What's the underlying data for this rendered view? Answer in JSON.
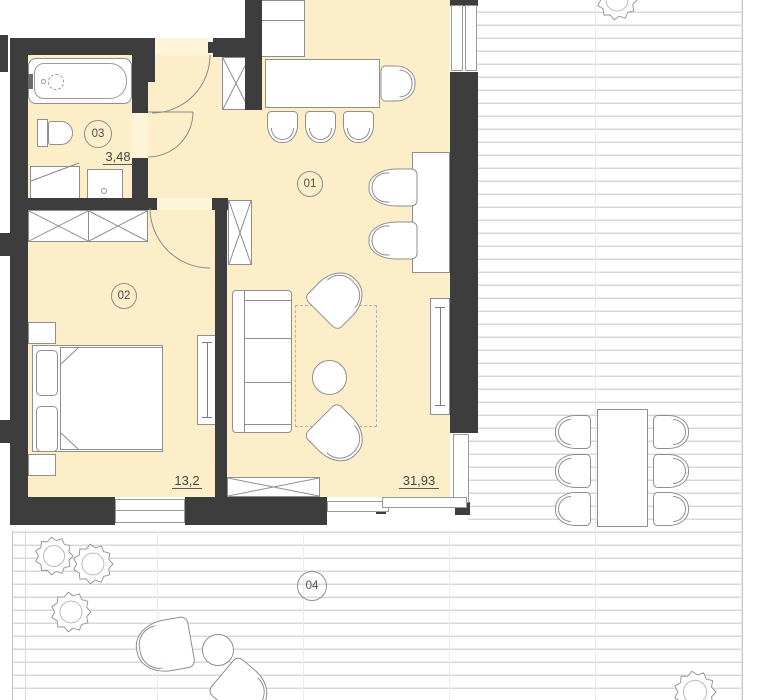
{
  "plan_title": "apartment-floor-plan-with-terrace",
  "rooms": {
    "living": {
      "number": "01",
      "area": "31,93"
    },
    "bedroom": {
      "number": "02",
      "area": "13,2"
    },
    "bath": {
      "number": "03",
      "area": "3,48"
    },
    "terrace": {
      "number": "04"
    }
  },
  "colors": {
    "wall": "#3d3d3d",
    "floor": "#fbeec9",
    "furniture_stroke": "#8f8f8f",
    "deck_line": "#d8d8d8",
    "label_text": "#474747"
  }
}
